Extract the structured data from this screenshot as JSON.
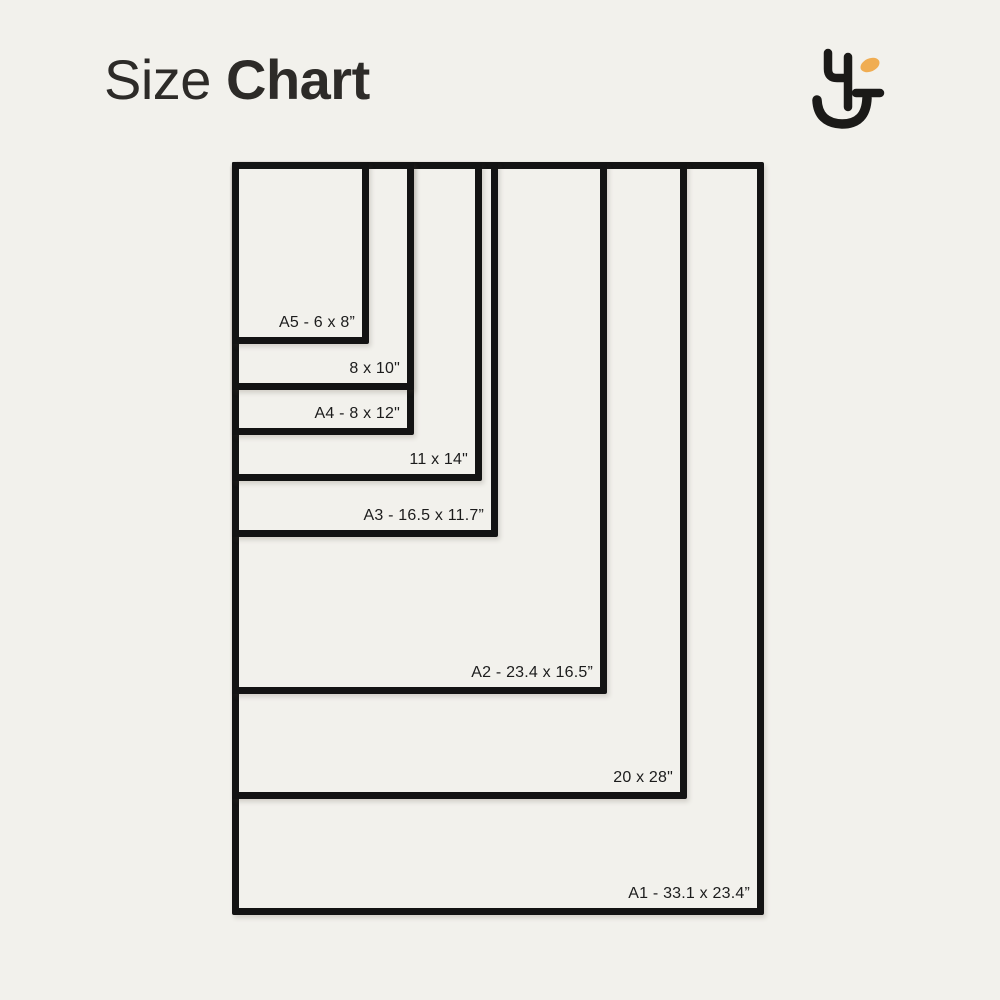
{
  "page": {
    "background_color": "#f2f1ec"
  },
  "header": {
    "title_regular": "Size",
    "title_bold": "Chart",
    "title_color": "#2d2b28"
  },
  "logo": {
    "description": "abstract smiley letterform mark",
    "stroke_color": "#1b1a18",
    "accent_color": "#f0ad52"
  },
  "chart_data": {
    "type": "diagram",
    "subtype": "nested-size-comparison",
    "title": "Size Chart",
    "unit": "inches",
    "scale_px_per_inch": 22.75,
    "origin_px": {
      "x": 232,
      "y": 162
    },
    "border_px": 7,
    "border_color": "#131313",
    "label_color": "#1c1c1c",
    "sizes": [
      {
        "name": "a5",
        "label": "A5 - 6 x 8”",
        "display_w_in": 6,
        "display_h_in": 8
      },
      {
        "name": "8x10",
        "label": "8 x 10\"",
        "display_w_in": 8,
        "display_h_in": 10
      },
      {
        "name": "a4",
        "label": "A4 - 8 x 12\"",
        "display_w_in": 8,
        "display_h_in": 12
      },
      {
        "name": "11x14",
        "label": "11 x 14\"",
        "display_w_in": 11,
        "display_h_in": 14
      },
      {
        "name": "a3",
        "label": "A3 - 16.5 x 11.7”",
        "display_w_in": 11.7,
        "display_h_in": 16.5
      },
      {
        "name": "a2",
        "label": "A2 - 23.4 x 16.5”",
        "display_w_in": 16.5,
        "display_h_in": 23.4
      },
      {
        "name": "20x28",
        "label": "20 x 28\"",
        "display_w_in": 20,
        "display_h_in": 28
      },
      {
        "name": "a1",
        "label": "A1 - 33.1 x 23.4”",
        "display_w_in": 23.4,
        "display_h_in": 33.1
      }
    ]
  }
}
